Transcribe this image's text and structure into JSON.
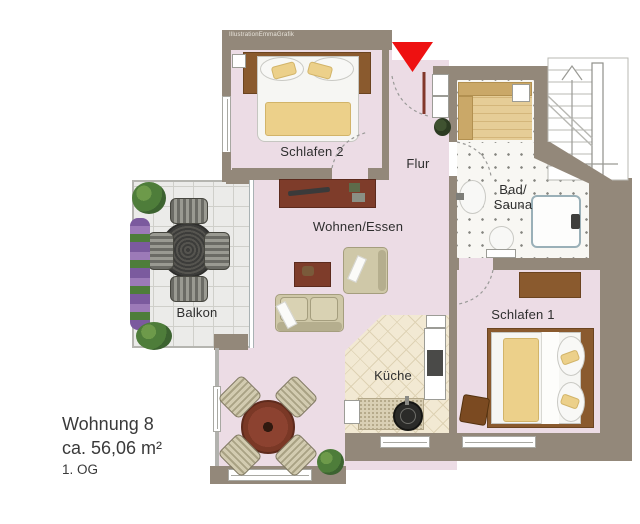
{
  "watermark": {
    "text": "IllustrationEmmaGrafik"
  },
  "rooms": {
    "schlafen2": {
      "label": "Schlafen 2"
    },
    "flur": {
      "label": "Flur"
    },
    "bad_sauna": {
      "label_line1": "Bad/",
      "label_line2": "Sauna"
    },
    "wohnen_essen": {
      "label": "Wohnen/Essen"
    },
    "balkon": {
      "label": "Balkon"
    },
    "kueche": {
      "label": "Küche"
    },
    "schlafen1": {
      "label": "Schlafen 1"
    }
  },
  "info": {
    "apartment": "Wohnung 8",
    "area": "ca. 56,06 m²",
    "floor": "1. OG"
  },
  "marker": {
    "entrance": "red-arrow-down",
    "color": "#ee1111"
  },
  "colors": {
    "wall": "#93887a",
    "floor": "#ecdce5",
    "kitchen_tile": "#f2e9d3",
    "bath_tile": "#f8f7f3",
    "balcony_tile": "#ebebe9",
    "wood_furniture": "#8a5a2e",
    "accent_furniture": "#7e3c2a",
    "upholstery": "#cfc8a8",
    "blanket": "#ecd08a"
  }
}
